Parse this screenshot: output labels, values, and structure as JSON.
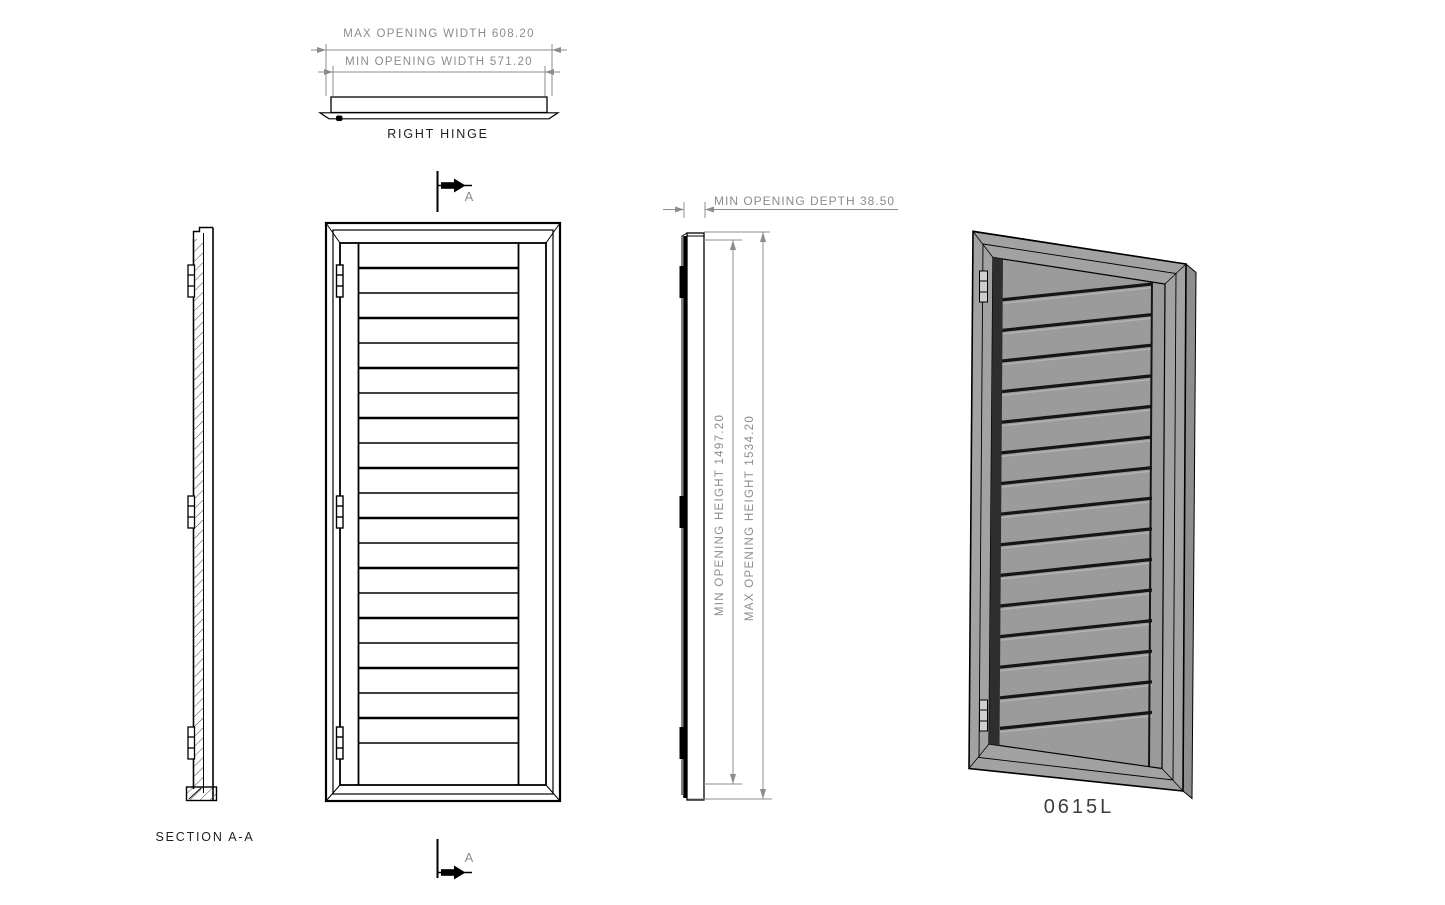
{
  "drawing": {
    "background": "#ffffff",
    "line_color": "#000000",
    "dim_color": "#8c8c8c",
    "label_color": "#1f1f1f",
    "top_view": {
      "dim_max_width": "MAX OPENING WIDTH 608.20",
      "dim_min_width": "MIN OPENING WIDTH 571.20",
      "label": "RIGHT HINGE"
    },
    "section_view": {
      "label": "SECTION A-A"
    },
    "front_view": {
      "section_marker": "A",
      "louver_line_count": 20,
      "hinge_count": 3
    },
    "side_view": {
      "dim_depth": "MIN OPENING DEPTH 38.50",
      "dim_min_height": "MIN OPENING HEIGHT 1497.20",
      "dim_max_height": "MAX OPENING HEIGHT 1534.20"
    },
    "iso_view": {
      "label": "0615L",
      "slat_count": 15,
      "hinge_count": 2,
      "frame_fill": "#a2a2a2",
      "panel_fill": "#9b9b9b"
    }
  }
}
